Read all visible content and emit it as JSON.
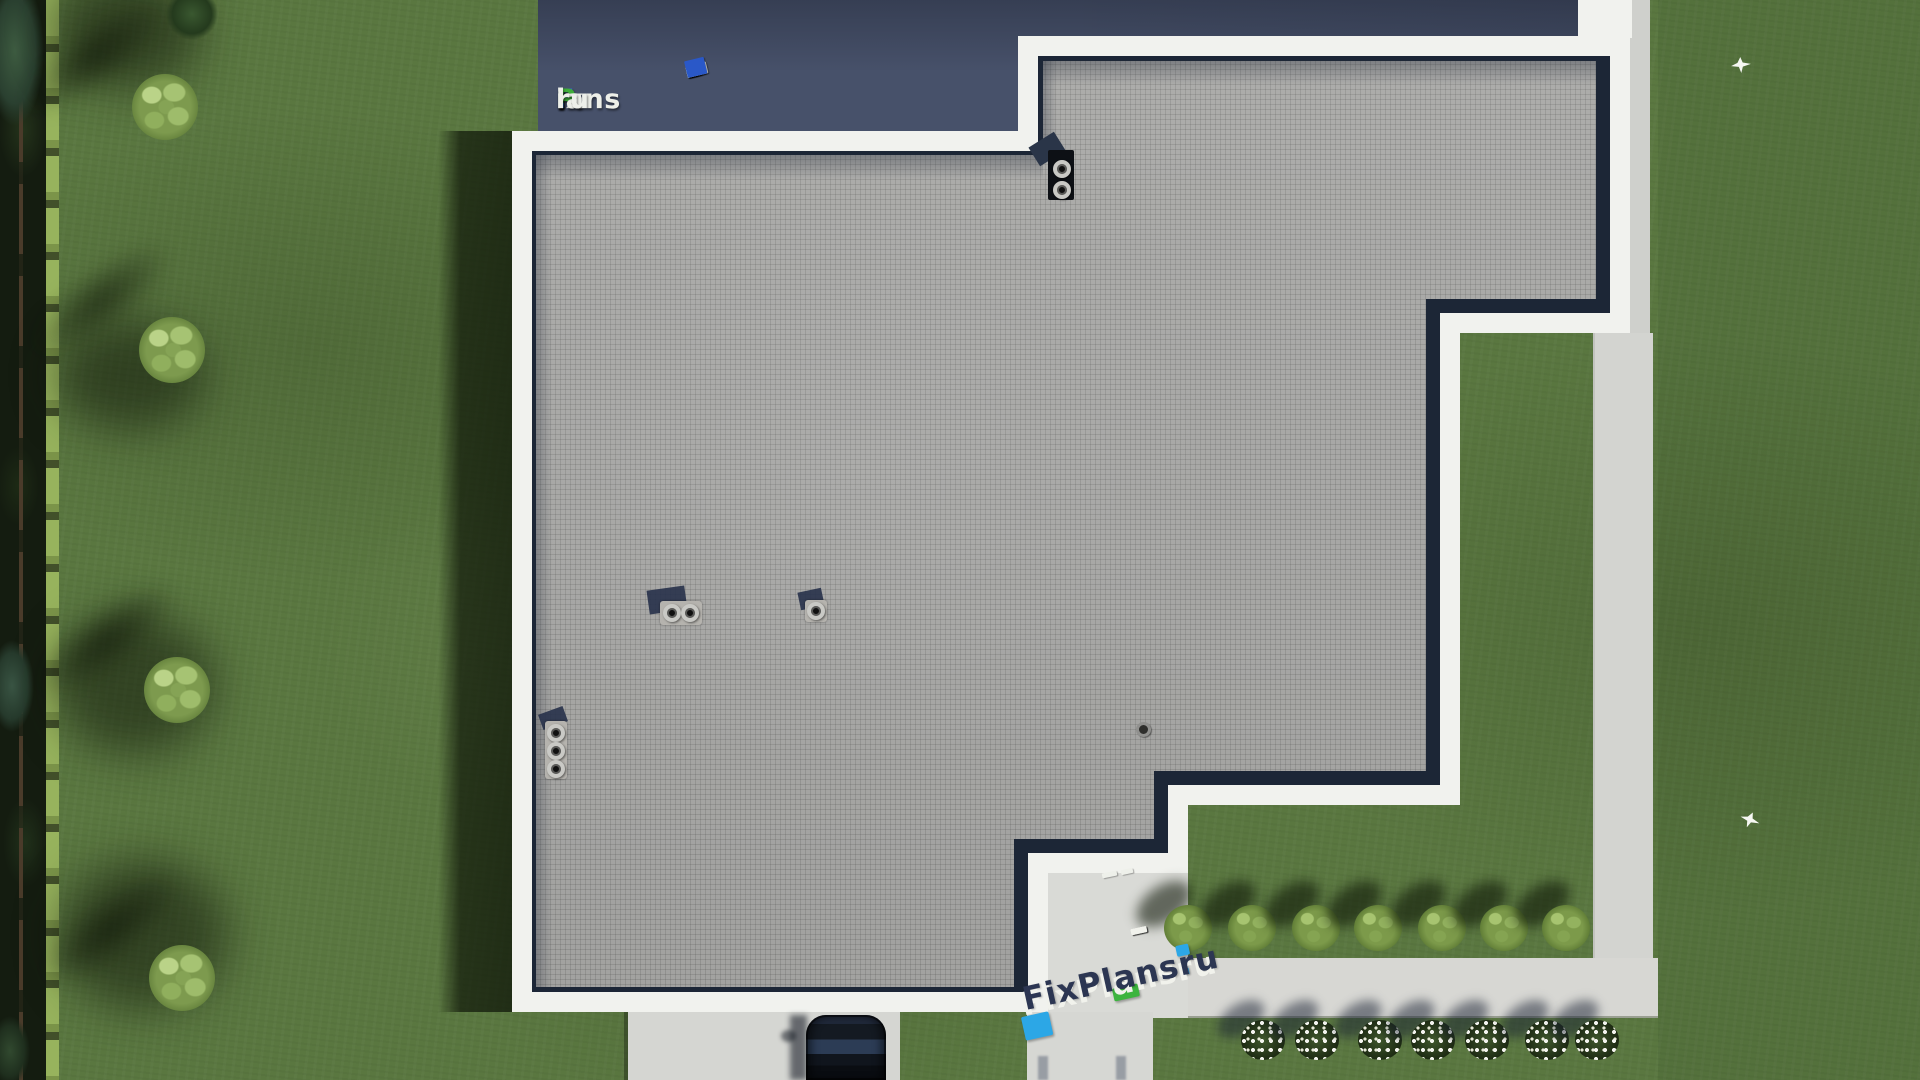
{
  "scene": {
    "description": "aerial top-down render of a flat-roof house with lawn",
    "source_watermark": "FixPlans.ru"
  },
  "watermark_top": {
    "text": "FixPlans.ru",
    "segments": [
      {
        "text": "F",
        "color": "#2f70d2"
      },
      {
        "text": "ix",
        "color": "#edefe9"
      },
      {
        "text": "P",
        "color": "#3fae3a"
      },
      {
        "text": "lans",
        "color": "#edefe9"
      },
      {
        "text": ".",
        "color": "#2f70d2"
      },
      {
        "text": "ru",
        "color": "#edefe9"
      }
    ],
    "dashes": [
      {
        "w": 9,
        "h": 6,
        "color": "#edefe9"
      },
      {
        "w": 11,
        "h": 7,
        "color": "#edefe9"
      },
      {
        "w": 10,
        "h": 7,
        "color": "#2a58c8"
      },
      {
        "w": 13,
        "h": 8,
        "color": "#edefe9"
      },
      {
        "w": 15,
        "h": 9,
        "color": "#edefe9"
      },
      {
        "w": 14,
        "h": 9,
        "color": "#edefe9"
      },
      {
        "w": 17,
        "h": 10,
        "color": "#3fae3a"
      },
      {
        "w": 19,
        "h": 11,
        "color": "#edefe9"
      },
      {
        "w": 21,
        "h": 12,
        "color": "#edefe9"
      },
      {
        "w": 20,
        "h": 17,
        "color": "#2a58c8"
      }
    ]
  },
  "watermark_bottom": {
    "text": "FixPlans",
    "dot": ".",
    "suffix": "ru",
    "letter_color": "#2c3652",
    "extrude_color": "#f1f2ec",
    "accent_blue": "#2ca7e6",
    "accent_green": "#3cb43e",
    "dash_count": 4
  },
  "palette": {
    "lawn": "#5a7740",
    "hedge": "#93b05a",
    "roof_paving": "#a9a9a7",
    "parapet": "#f1f2ee",
    "edge_shadow": "#1c2636",
    "north_band": "#47516a",
    "walkway": "#d5d6d2",
    "car_body": "#141a22",
    "car_glass": "#2c3c55"
  },
  "landscape": {
    "trees": [
      {
        "x": 165,
        "y": 107
      },
      {
        "x": 172,
        "y": 350
      },
      {
        "x": 177,
        "y": 690
      },
      {
        "x": 182,
        "y": 978
      }
    ],
    "tree_shadow_offset": {
      "dx": -72,
      "dy": -50
    },
    "green_shrubs_x": [
      1188,
      1252,
      1316,
      1378,
      1442,
      1504,
      1566
    ],
    "green_shrubs_y": 928,
    "flower_shrubs_x": [
      1263,
      1317,
      1380,
      1433,
      1487,
      1547,
      1597
    ],
    "flower_shrubs_y": 1040,
    "birds": [
      {
        "x": 1731,
        "y": 57
      },
      {
        "x": 1740,
        "y": 812
      }
    ]
  },
  "roof_fixtures": {
    "chimney_caps": [
      {
        "x": 1062,
        "y": 169
      },
      {
        "x": 1062,
        "y": 190
      }
    ],
    "twin_vent_caps": [
      {
        "x": 672,
        "y": 613
      },
      {
        "x": 690,
        "y": 613
      }
    ],
    "single_vent_cap": [
      {
        "x": 816,
        "y": 611
      }
    ],
    "triple_vent_caps": [
      {
        "x": 556,
        "y": 733
      },
      {
        "x": 556,
        "y": 751
      },
      {
        "x": 556,
        "y": 769
      }
    ],
    "drain": {
      "x": 1143,
      "y": 729
    }
  }
}
